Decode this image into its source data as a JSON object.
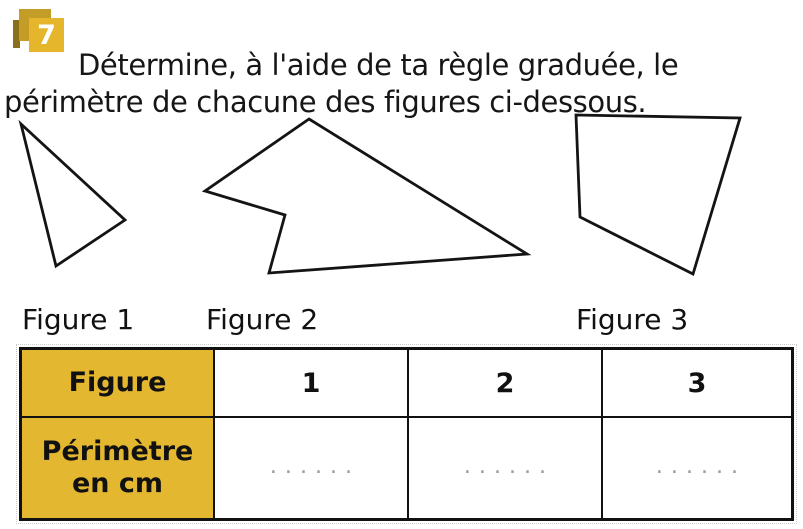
{
  "exercise": {
    "number": "7",
    "instruction": "Détermine, à l'aide de ta règle graduée, le périmètre de chacune des figures ci-dessous."
  },
  "figures": [
    {
      "label": "Figure 1",
      "points": "21,124 125,220 56,266"
    },
    {
      "label": "Figure 2",
      "points": "309,119 527,254 269,273 285,215 205,191"
    },
    {
      "label": "Figure 3",
      "points": "576,115 740,118 693,274 580,217"
    }
  ],
  "table": {
    "header_row": {
      "label": "Figure",
      "values": [
        "1",
        "2",
        "3"
      ]
    },
    "perimeter_row": {
      "label": "Périmètre en cm",
      "values": [
        "......",
        "......",
        "......"
      ]
    }
  },
  "colors": {
    "badge_front": "#e5b62c",
    "badge_back": "#c49d28",
    "badge_strip": "#8a701c",
    "header_bg": "#e3b72f",
    "dots": "#9e9e9e"
  }
}
